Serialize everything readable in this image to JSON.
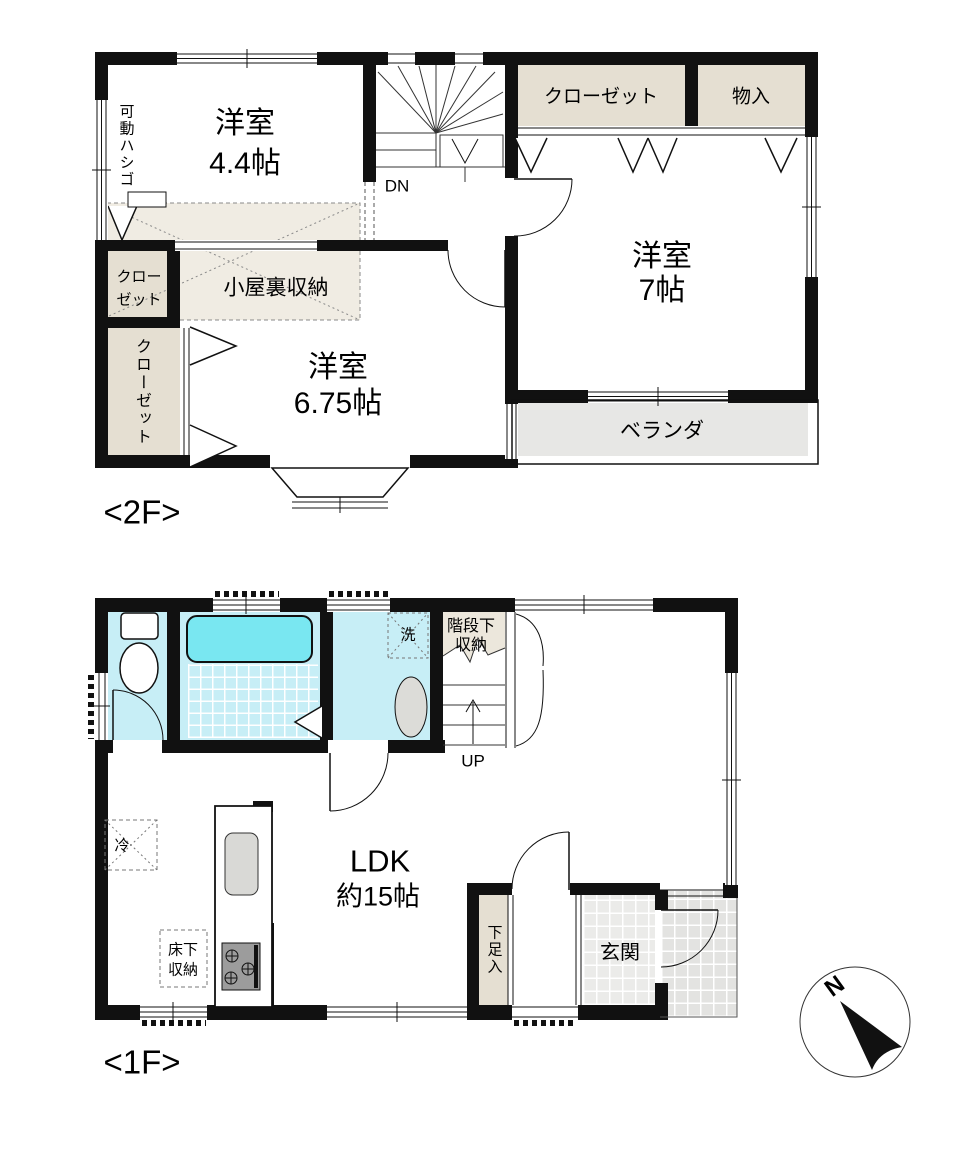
{
  "palette": {
    "wall": "#111111",
    "closet_fill": "#e5dfd2",
    "attic_fill": "#f0ece3",
    "wet_room_fill": "#c7eef6",
    "bathtub_fill": "#79e7f1",
    "veranda_fill": "#e7e7e5",
    "entrance_tile_fill": "#ebebe9",
    "porch_fill": "#e3e3e1"
  },
  "f2": {
    "floor_label": "<2F>",
    "room_44": {
      "l1": "洋室",
      "l2": "4.4帖"
    },
    "ladder": "可動ハシゴ",
    "stairs_dn": "DN",
    "closet_top": "クローゼット",
    "storage_monoire": "物入",
    "room_7": {
      "l1": "洋室",
      "l2": "7帖"
    },
    "closet_small": {
      "l1": "クロー",
      "l2": "ゼット"
    },
    "closet_tall": "クローゼット",
    "attic": "小屋裏収納",
    "room_675": {
      "l1": "洋室",
      "l2": "6.75帖"
    },
    "veranda": "ベランダ"
  },
  "f1": {
    "floor_label": "<1F>",
    "under_stair": {
      "l1": "階段下",
      "l2": "収納"
    },
    "stairs_up": "UP",
    "laundry": "洗",
    "ldk": {
      "l1": "LDK",
      "l2": "約15帖"
    },
    "fridge": "冷",
    "floor_storage": {
      "l1": "床下",
      "l2": "収納"
    },
    "shoe_box": "下足入",
    "entrance": "玄関"
  },
  "compass": {
    "north": "N"
  }
}
